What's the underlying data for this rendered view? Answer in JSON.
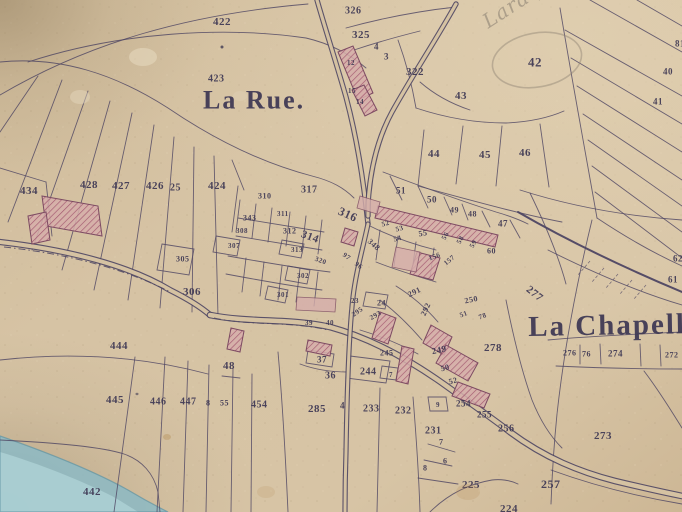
{
  "map": {
    "meta": {
      "width": 682,
      "height": 512,
      "kind": "historic cadastral map sheet"
    },
    "colors": {
      "paper": "#d5c2a2",
      "paper_light": "#decbae",
      "paper_dark": "#c0a985",
      "ink": "#4e4663",
      "ink_text": "#3e3854",
      "building_fill": "#d6aeab",
      "building_hatch": "#a2566f",
      "building_stroke": "#7c4a62",
      "pencil": "#8d8273",
      "river_outer": "#8fb9c2",
      "river_inner": "#aed2d6",
      "river_edge": "#5e93a2"
    },
    "place_labels": [
      {
        "text": "La Rue.",
        "x": 203,
        "y": 90,
        "size": 26,
        "rot": 0
      },
      {
        "text": "La Chapell",
        "x": 528,
        "y": 316,
        "size": 29,
        "rot": -1
      }
    ],
    "pencil": {
      "annotations": [
        {
          "text": "Laraque",
          "x": 480,
          "y": 16,
          "size": 20,
          "rot": -33
        }
      ],
      "circle": {
        "cx": 537,
        "cy": 60,
        "rx": 45,
        "ry": 27,
        "rot": -10
      }
    },
    "parcels": [
      [
        "422",
        213,
        18,
        11
      ],
      [
        "423",
        208,
        75,
        10
      ],
      [
        "434",
        20,
        187,
        11
      ],
      [
        "428",
        80,
        181,
        11
      ],
      [
        "427",
        112,
        182,
        11
      ],
      [
        "426",
        146,
        182,
        11
      ],
      [
        "25",
        170,
        184,
        10
      ],
      [
        "424",
        208,
        182,
        11
      ],
      [
        "326",
        345,
        7,
        10
      ],
      [
        "325",
        352,
        31,
        11
      ],
      [
        "4",
        374,
        43,
        9
      ],
      [
        "3",
        384,
        53,
        9
      ],
      [
        "322",
        406,
        68,
        11
      ],
      [
        "12",
        347,
        60,
        7
      ],
      [
        "15",
        348,
        88,
        7
      ],
      [
        "14",
        356,
        99,
        7
      ],
      [
        "42",
        528,
        57,
        13
      ],
      [
        "43",
        455,
        92,
        11
      ],
      [
        "44",
        428,
        150,
        11
      ],
      [
        "45",
        479,
        151,
        11
      ],
      [
        "46",
        519,
        149,
        11
      ],
      [
        "81",
        675,
        40,
        9
      ],
      [
        "40",
        663,
        68,
        9
      ],
      [
        "41",
        653,
        98,
        9
      ],
      [
        "62",
        673,
        255,
        9
      ],
      [
        "61",
        668,
        276,
        9
      ],
      [
        "51",
        396,
        187,
        9
      ],
      [
        "50",
        427,
        196,
        9
      ],
      [
        "49",
        450,
        207,
        8
      ],
      [
        "48",
        468,
        211,
        8
      ],
      [
        "47",
        498,
        220,
        9
      ],
      [
        "316",
        341,
        206,
        12,
        24
      ],
      [
        "317",
        301,
        186,
        10
      ],
      [
        "310",
        258,
        193,
        8
      ],
      [
        "311",
        277,
        211,
        7
      ],
      [
        "343",
        243,
        215,
        8
      ],
      [
        "312",
        283,
        228,
        8
      ],
      [
        "314",
        303,
        230,
        11,
        20
      ],
      [
        "308",
        236,
        228,
        7
      ],
      [
        "307",
        228,
        243,
        7
      ],
      [
        "313",
        291,
        247,
        7
      ],
      [
        "305",
        176,
        256,
        8
      ],
      [
        "306",
        183,
        288,
        11
      ],
      [
        "302",
        297,
        273,
        7
      ],
      [
        "301",
        277,
        292,
        7
      ],
      [
        "320",
        316,
        256,
        7,
        20
      ],
      [
        "97",
        345,
        252,
        7,
        35
      ],
      [
        "96",
        357,
        261,
        7,
        35
      ],
      [
        "348",
        371,
        238,
        8,
        42
      ],
      [
        "52",
        381,
        222,
        7,
        -15
      ],
      [
        "53",
        395,
        227,
        7,
        -15
      ],
      [
        "54",
        393,
        237,
        7,
        -15
      ],
      [
        "55",
        418,
        231,
        8,
        -10
      ],
      [
        "56",
        441,
        238,
        7,
        -60
      ],
      [
        "58",
        456,
        242,
        7,
        -60
      ],
      [
        "59",
        469,
        246,
        7,
        -60
      ],
      [
        "60",
        487,
        248,
        8
      ],
      [
        "156",
        428,
        256,
        7,
        -20
      ],
      [
        "157",
        443,
        262,
        7,
        -40
      ],
      [
        "39",
        305,
        320,
        7
      ],
      [
        "40",
        326,
        320,
        7
      ],
      [
        "23",
        351,
        298,
        7
      ],
      [
        "24",
        377,
        300,
        8
      ],
      [
        "291",
        407,
        292,
        8,
        -25
      ],
      [
        "292",
        420,
        314,
        8,
        -65
      ],
      [
        "293",
        369,
        316,
        7,
        -30
      ],
      [
        "295",
        351,
        313,
        7,
        -35
      ],
      [
        "245",
        380,
        350,
        8
      ],
      [
        "244",
        360,
        368,
        10
      ],
      [
        "7",
        389,
        372,
        7
      ],
      [
        "37",
        317,
        356,
        9
      ],
      [
        "36",
        325,
        372,
        10
      ],
      [
        "48",
        223,
        362,
        11
      ],
      [
        "249",
        431,
        348,
        9,
        -12
      ],
      [
        "250",
        464,
        298,
        8,
        -12
      ],
      [
        "51",
        459,
        313,
        7,
        -20
      ],
      [
        "78",
        478,
        315,
        7,
        -20
      ],
      [
        "278",
        484,
        344,
        11
      ],
      [
        "50",
        440,
        366,
        8,
        -15
      ],
      [
        "52",
        448,
        379,
        8,
        -15
      ],
      [
        "254",
        456,
        400,
        9
      ],
      [
        "9",
        436,
        402,
        7
      ],
      [
        "255",
        477,
        411,
        9
      ],
      [
        "256",
        498,
        425,
        10
      ],
      [
        "231",
        425,
        427,
        10
      ],
      [
        "7",
        439,
        439,
        8
      ],
      [
        "6",
        443,
        458,
        8
      ],
      [
        "8",
        423,
        465,
        8
      ],
      [
        "225",
        462,
        481,
        11
      ],
      [
        "224",
        500,
        505,
        11
      ],
      [
        "257",
        541,
        479,
        12
      ],
      [
        "273",
        594,
        432,
        11
      ],
      [
        "277",
        530,
        285,
        11,
        38
      ],
      [
        "276",
        563,
        350,
        8
      ],
      [
        "76",
        582,
        351,
        8
      ],
      [
        "274",
        608,
        350,
        9
      ],
      [
        "272",
        665,
        352,
        8
      ],
      [
        "444",
        110,
        342,
        11
      ],
      [
        "445",
        106,
        396,
        11
      ],
      [
        "446",
        150,
        398,
        10
      ],
      [
        "447",
        180,
        398,
        10
      ],
      [
        "8",
        206,
        400,
        8
      ],
      [
        "55",
        220,
        400,
        8
      ],
      [
        "454",
        251,
        401,
        10
      ],
      [
        "285",
        308,
        405,
        11
      ],
      [
        "4",
        340,
        402,
        9
      ],
      [
        "233",
        363,
        405,
        10
      ],
      [
        "232",
        395,
        407,
        10
      ],
      [
        "442",
        83,
        488,
        11
      ]
    ],
    "roads": [
      {
        "d": "M0,242 C70,250 130,266 170,290 C190,300 202,308 210,315",
        "w": 4,
        "style": "double"
      },
      {
        "d": "M210,315 C250,323 290,318 330,327 C370,338 410,360 445,385 C470,403 492,418 510,432 C545,458 580,472 615,481 C640,487 662,492 682,496",
        "w": 4.5,
        "style": "double"
      },
      {
        "d": "M317,0 C325,28 336,62 346,97 C354,127 360,160 364,190 C366,205 367,215 368,224",
        "w": 3.2,
        "style": "double"
      },
      {
        "d": "M456,4 C436,40 412,76 392,112 C380,134 372,162 369,192 C368,200 368,208 368,216",
        "w": 3.2,
        "style": "double"
      },
      {
        "d": "M368,224 C362,252 356,272 353,297 C349,332 347,392 346,452 C345,482 345,498 345,512",
        "w": 3,
        "style": "double"
      },
      {
        "d": "M518,212 C556,234 606,260 682,292",
        "w": 2,
        "style": "single"
      }
    ],
    "dashdot": [
      "M4,247 C70,254 128,270 170,292",
      "M214,318 C250,326 290,321 328,330"
    ],
    "road_ticks": [
      "M604,268 L592,282",
      "M618,274 L606,288",
      "M632,280 L620,294",
      "M646,285 L634,299",
      "M590,261 L578,275"
    ],
    "boundaries": [
      "M0,95 C90,42 190,14 308,4",
      "M0,62 C60,56 115,74 168,108 C215,140 262,163 312,176 C332,181 344,188 354,198",
      "M28,62 C120,32 225,26 306,38 C332,44 352,56 366,68",
      "M38,76 L0,132",
      "M62,80 L8,222",
      "M88,91 L32,250",
      "M110,101 L62,270",
      "M132,113 L94,290",
      "M154,125 L128,300",
      "M174,137 L160,308",
      "M194,147 L192,312",
      "M214,156 L218,316",
      "M0,168 L46,182",
      "M46,182 L52,236",
      "M232,160 L244,190",
      "M560,8 C572,80 585,150 597,218",
      "M565,30 L682,96",
      "M571,58 L682,124",
      "M577,86 L682,152",
      "M583,114 L682,180",
      "M588,140 L682,206",
      "M592,166 L682,232",
      "M595,192 L682,258",
      "M590,0 L682,52",
      "M637,0 L682,26",
      "M597,218 C630,240 660,256 682,266",
      "M548,250 C600,276 645,294 682,305",
      "M416,108 C446,118 476,123 506,123 C528,122 548,118 564,111",
      "M420,82 C436,96 452,104 470,110",
      "M398,40 C406,62 412,85 416,108",
      "M346,28 C390,16 428,10 456,7",
      "M354,50 C378,42 400,36 420,31",
      "M463,126 L456,184",
      "M502,126 L496,186",
      "M540,124 L549,187",
      "M424,130 L418,186",
      "M418,186 C470,200 520,214 562,222",
      "M383,172 C420,186 458,200 496,212 C510,216 520,220 528,224",
      "M390,176 L402,200",
      "M418,186 L428,208",
      "M444,197 L452,215",
      "M462,204 L468,220",
      "M482,211 L490,227",
      "M510,220 L520,238",
      "M530,193 C545,224 558,254 566,284",
      "M238,186 L232,232",
      "M240,200 L236,232",
      "M256,204 L252,238",
      "M272,208 L268,242",
      "M290,212 L286,246",
      "M306,216 L302,250",
      "M322,220 L318,254",
      "M238,218 L324,232",
      "M236,236 L322,250",
      "M228,256 C262,262 296,268 330,272",
      "M226,274 C258,280 290,286 322,290",
      "M246,258 L242,292",
      "M264,262 L260,296",
      "M282,266 L278,300",
      "M300,268 L296,302",
      "M318,272 L314,306",
      "M162,244 l32,5 l-5,26 l-32,-5 z",
      "M216,236 l24,4 l-3,16 l-24,-4 z",
      "M282,240 l22,4 l-3,14 l-22,-4 z",
      "M288,266 l22,4 l-3,14 l-22,-4 z",
      "M268,286 l20,4 l-3,13 l-20,-4 z",
      "M370,226 C390,236 412,244 436,250",
      "M380,230 L376,260",
      "M398,236 L394,266",
      "M416,242 L412,272",
      "M434,248 L430,278",
      "M376,262 C396,270 416,276 436,282",
      "M396,286 C412,296 426,308 438,322",
      "M380,300 C396,312 410,326 422,340",
      "M360,330 C380,336 400,344 418,354",
      "M506,300 C514,340 522,372 532,400 C540,420 550,436 562,448",
      "M520,190 C570,206 625,216 682,220",
      "M592,220 C576,286 564,350 557,414 C554,444 552,476 551,504",
      "M548,340 C590,336 640,334 682,332",
      "M556,366 C600,368 640,369 682,369",
      "M580,345 L580,364",
      "M600,344 L601,364",
      "M640,344 L641,366",
      "M660,345 L661,366",
      "M644,371 C660,392 672,412 682,428",
      "M551,470 C595,486 640,497 682,504",
      "M0,360 C70,352 140,356 208,374",
      "M135,357 L114,512",
      "M165,357 L157,512",
      "M188,361 L183,512",
      "M209,365 L206,512",
      "M233,369 L231,512",
      "M252,374 L251,512",
      "M278,352 C284,420 286,470 288,512",
      "M0,440 C60,443 102,447 124,454 C142,460 154,474 158,492 L160,512",
      "M380,388 L377,512",
      "M413,397 C417,446 419,480 420,512",
      "M428,444 L455,452",
      "M424,460 L452,466",
      "M418,478 L458,484",
      "M430,512 C448,494 468,484 492,480 C500,479 510,480 518,484",
      "M428,397 h18 l2,14 h-18 z",
      "M382,366 l16,2 l-2,12 l-16,-2 z",
      "M350,356 l40,5 l-4,22 l-40,-5 z",
      "M308,350 l26,4 l-2,13 l-26,-4 z",
      "M366,292 l22,3 l-3,14 l-22,-3 z",
      "M300,364 C316,370 332,372 348,372",
      "M222,376 L240,378"
    ],
    "buildings": {
      "hatched": [
        "42,196 98,206 102,236 46,226",
        "28,216 46,212 50,240 32,244",
        "338,52 353,46 373,93 358,100",
        "352,90 364,85 377,110 365,116",
        "378,206 498,235 495,247 375,218",
        "417,252 440,258 433,280 410,274",
        "380,312 396,318 388,344 372,338",
        "431,325 452,337 444,355 423,343",
        "446,345 478,363 468,381 436,363",
        "458,382 490,394 484,408 452,396",
        "308,340 332,345 330,356 306,351",
        "402,346 414,349 408,384 396,381",
        "231,328 244,331 240,352 227,349",
        "345,228 358,232 354,246 341,242"
      ],
      "plain": [
        "360,196 380,202 377,214 357,208",
        "297,297 336,299 335,312 296,310",
        "396,247 420,252 416,272 392,267"
      ]
    },
    "river": {
      "outer": "M0,436 C46,452 92,470 128,490 C148,502 160,508 168,512 L0,512 Z",
      "inner": "M0,452 C40,464 80,480 112,496 C124,503 132,508 138,512 L0,512 Z"
    },
    "stains": [
      {
        "cx": 143,
        "cy": 57,
        "rx": 14,
        "ry": 9,
        "fill": "#ead候",
        "o": 0
      },
      {
        "cx": 143,
        "cy": 57,
        "rx": 14,
        "ry": 9,
        "fill": "#eaddc4",
        "o": 0.5
      },
      {
        "cx": 80,
        "cy": 97,
        "rx": 10,
        "ry": 7,
        "fill": "#e6dac2",
        "o": 0.45
      },
      {
        "cx": 240,
        "cy": 96,
        "rx": 7,
        "ry": 5,
        "fill": "#e2d4ba",
        "o": 0.35
      },
      {
        "cx": 468,
        "cy": 492,
        "rx": 12,
        "ry": 8,
        "fill": "#b98f55",
        "o": 0.22
      },
      {
        "cx": 266,
        "cy": 492,
        "rx": 9,
        "ry": 6,
        "fill": "#b08648",
        "o": 0.15
      },
      {
        "cx": 167,
        "cy": 437,
        "rx": 4,
        "ry": 3,
        "fill": "#a97f3f",
        "o": 0.3
      },
      {
        "cx": 222,
        "cy": 47,
        "rx": 1.5,
        "ry": 1.5,
        "fill": "#3f3a52",
        "o": 0.8
      },
      {
        "cx": 137,
        "cy": 394,
        "rx": 1.5,
        "ry": 1.2,
        "fill": "#3f3a52",
        "o": 0.6
      }
    ]
  }
}
